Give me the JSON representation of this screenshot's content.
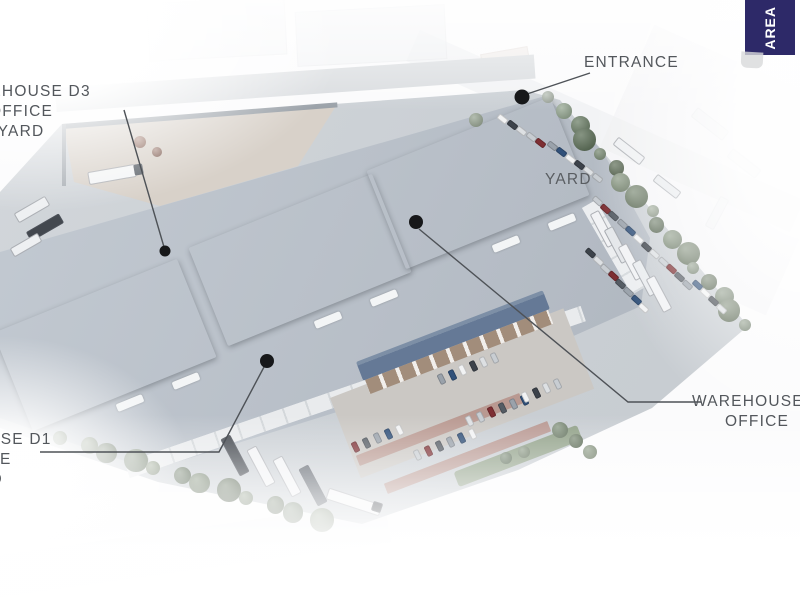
{
  "banner": {
    "label": "AREA",
    "color": "#2d2968"
  },
  "callouts": {
    "warehouse_d3": {
      "lines": [
        "WAREHOUSE D3",
        "OFFICE",
        "YARD"
      ]
    },
    "warehouse_d1": {
      "lines": [
        "WAREHOUSE D1",
        "OFFICE",
        "YARD"
      ]
    },
    "warehouse_d2": {
      "lines": [
        "WAREHOUSE D2",
        "OFFICE"
      ]
    },
    "entrance": {
      "label": "ENTRANCE"
    },
    "yard": {
      "label": "YARD"
    }
  },
  "colors": {
    "label_text": "#53575c",
    "leader_line": "#4e5257",
    "marker_dot": "#17181a",
    "site_ground": "#cbd0d5",
    "flat_roof": "#b6bdc6",
    "warehouse_roof_light_slope": "#5d636c",
    "warehouse_roof_dark_slope": "#474d56",
    "office_roof": "#657996",
    "office_facade": "#a28d7b",
    "d3_yard_concrete": "#d8d1c9",
    "parking_brick": "#b7938c",
    "tree_green": "#64785f",
    "banner_navy": "#2d2968"
  }
}
